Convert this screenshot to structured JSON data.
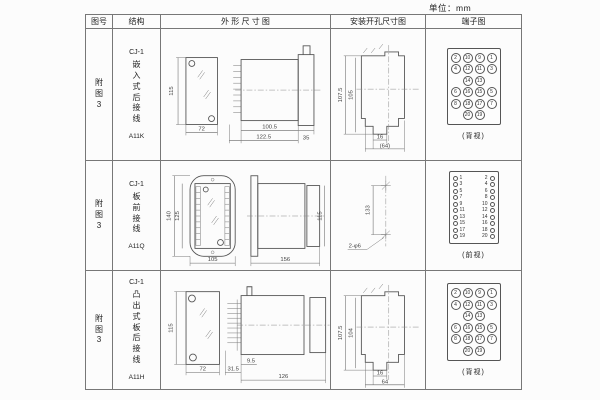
{
  "page": {
    "unit_label": "单位：mm"
  },
  "table": {
    "headers": {
      "fig": "图号",
      "structure": "结构",
      "outline": "外 形 尺 寸 图",
      "mounting": "安装开孔尺寸图",
      "terminal": "端子图"
    }
  },
  "rows": [
    {
      "fig_no": "附图3",
      "series": "CJ-1",
      "structure": "嵌入式后接线",
      "model": "A11K",
      "outline": {
        "front_h": "115",
        "front_w": "72",
        "body_len": "100.5",
        "total_len": "122.5",
        "flange": "35"
      },
      "mounting": {
        "v_outer": "107.5",
        "v_inner": "105",
        "h_inner": "16",
        "h_outer": "(64)"
      },
      "terminal": {
        "view_label": "(背视)",
        "type": "grid",
        "rows": [
          [
            2,
            10,
            9,
            1
          ],
          [
            4,
            12,
            11,
            3
          ],
          [
            14,
            13
          ],
          [
            6,
            16,
            15,
            5
          ],
          [
            8,
            18,
            17,
            7
          ],
          [
            20,
            19
          ]
        ]
      }
    },
    {
      "fig_no": "附图3",
      "series": "CJ-1",
      "structure": "板前接线",
      "model": "A11Q",
      "outline": {
        "front_h_outer": "140",
        "front_h_inner": "125",
        "front_w": "105",
        "side_len": "156",
        "side_h": "115"
      },
      "mounting": {
        "v": "133",
        "hole_label": "2-φ6"
      },
      "terminal": {
        "view_label": "(前视)",
        "type": "columns",
        "left": [
          1,
          3,
          5,
          7,
          9,
          11,
          13,
          15,
          17,
          19
        ],
        "right": [
          2,
          4,
          6,
          8,
          10,
          12,
          14,
          16,
          18,
          20
        ]
      }
    },
    {
      "fig_no": "附图3",
      "series": "CJ-1",
      "structure": "凸出式板后接线",
      "model": "A11H",
      "outline": {
        "front_h": "115",
        "front_w": "72",
        "pin_len": "31.5",
        "pin_gap": "9.5",
        "side_len": "126"
      },
      "mounting": {
        "v_outer": "107.5",
        "v_inner": "104",
        "h_inner": "16",
        "h_outer": "64"
      },
      "terminal": {
        "view_label": "(背视)",
        "type": "grid",
        "rows": [
          [
            2,
            10,
            9,
            1
          ],
          [
            4,
            12,
            11,
            3
          ],
          [
            14,
            13
          ],
          [
            6,
            16,
            15,
            5
          ],
          [
            8,
            18,
            17,
            7
          ],
          [
            20,
            19
          ]
        ]
      }
    }
  ]
}
